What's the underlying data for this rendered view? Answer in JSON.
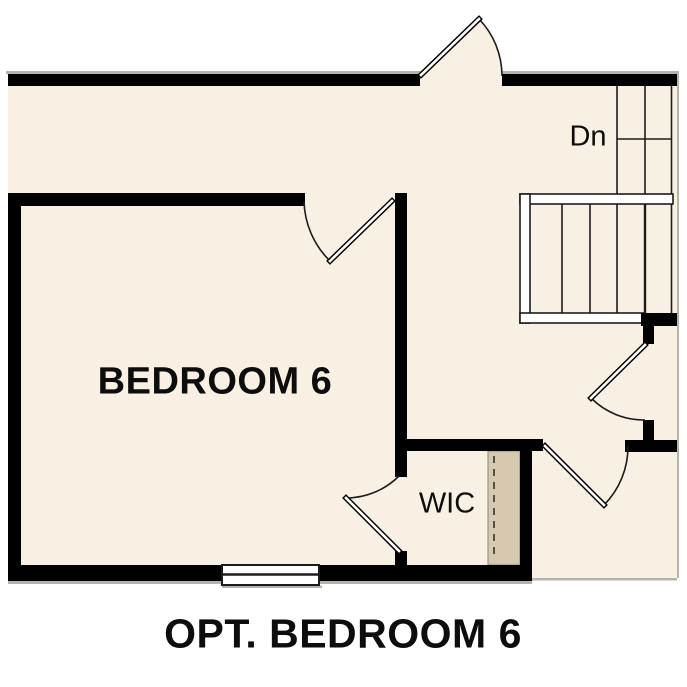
{
  "title": "OPT. BEDROOM 6",
  "rooms": {
    "bedroom": {
      "label": "BEDROOM 6"
    },
    "closet": {
      "label": "WIC"
    },
    "stairs": {
      "label": "Dn"
    }
  },
  "colors": {
    "floor": "#f7f0e3",
    "shelf": "#d7c9af",
    "wall": "#000000",
    "line": "#1c1c1c",
    "shadow": "#b8b3aa",
    "background": "#ffffff",
    "text": "#0d0d0d"
  }
}
